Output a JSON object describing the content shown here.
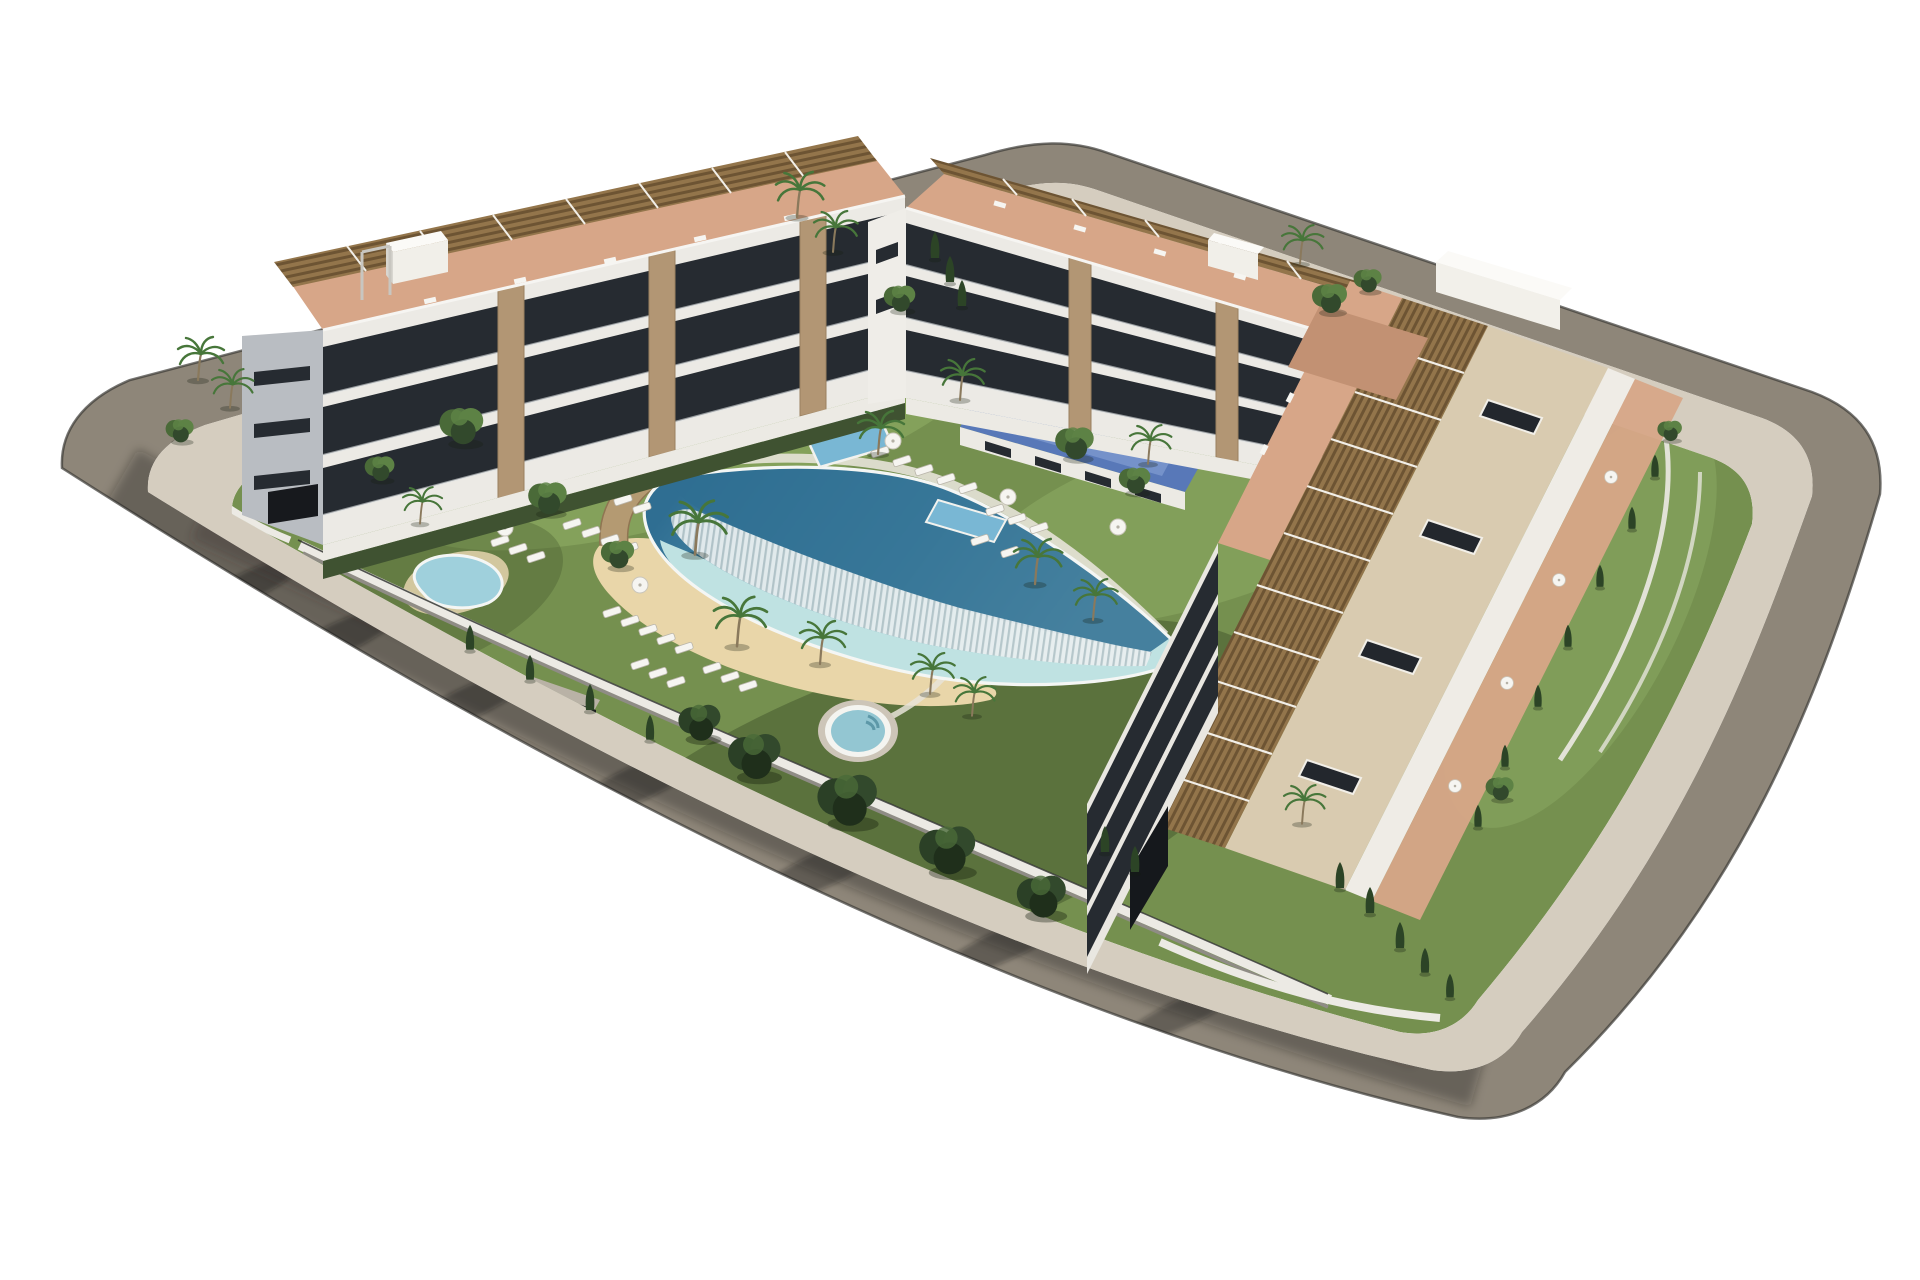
{
  "image_type": "architectural_3d_render",
  "subject": "Aerial isometric 3D rendering of a modern white Mediterranean apartment complex built around a landscaped courtyard with a lagoon-style pool, on a rounded corner plot surrounded by an empty asphalt road on a plain white background",
  "environment": {
    "background": "plain white, no context",
    "lighting": "bright sunlight from the upper right",
    "shadow_direction": "cast toward lower left, long tree shadows on the road"
  },
  "site": {
    "road": "asphalt ring road wrapping the whole plot with rounded corners",
    "sidewalk": "light paved sidewalk band inside the road",
    "perimeter": "white garden walls with hedges, cypresses and dark metal fencing"
  },
  "buildings": [
    {
      "id": "west-wing",
      "position": "upper left",
      "floors_visible": 4,
      "features": [
        "white slab facades",
        "dark glazed balcony bands",
        "stone-clad piers",
        "terracotta rooftop terraces",
        "row of brown louvered pergolas",
        "small rooftop pavilion",
        "garage opening at street level"
      ]
    },
    {
      "id": "north-wing",
      "position": "upper centre",
      "floors_visible": 3,
      "features": [
        "white slab facades",
        "dark glazed balcony bands",
        "stone-clad piers",
        "terracotta rooftop terraces with pergolas",
        "blue leisure deck at its base",
        "white podium wall"
      ]
    },
    {
      "id": "east-wing",
      "position": "right",
      "floors_visible": 4,
      "features": [
        "long flat beige roof with dark skylights",
        "continuous row of brown louvered pergola terraces",
        "dark curtain-wall facade to the courtyard",
        "street-side terraces with white parasols",
        "white rooftop box at north end",
        "garage opening at south end"
      ]
    }
  ],
  "amenities": [
    "curved lagoon swimming pool with infinity wave edge and white ribbed cascade wall",
    "sandy beach entry around the pool",
    "round spa / jacuzzi pool with steps",
    "kidney-shaped splash pool",
    "small plunge pool",
    "raised blue sports-and-leisure deck",
    "sun loungers in rows on the lawns",
    "white parasols",
    "palm trees, round garden trees and cypresses"
  ],
  "counts": {
    "main_buildings": 3,
    "water_features": 5,
    "lagoon_pools": 1,
    "spa_pools": 1
  },
  "palette": {
    "bg": "#ffffff",
    "road": "#8e8679",
    "sidewalk": "#d5cdbf",
    "lawn": "#75904f",
    "lawn_bright": "#8fae66",
    "lawn_shade": "#46592f",
    "sand": "#e9d6a9",
    "pool_deep": "#2f6e92",
    "pool_mid": "#66a4ba",
    "pool_shallow": "#bfe2e2",
    "pool_rim": "#f4f6f4",
    "stone_wall": "#b49a72",
    "wall_white": "#eceae4",
    "wall_shade": "#8f8c85",
    "bldg_white": "#eceae5",
    "gable_shade": "#b9bdc2",
    "glass_dark": "#262b31",
    "terracotta": "#d7a688",
    "terracotta_shade": "#c29173",
    "pergola": "#93754b",
    "pergola_stripe": "#6d5433",
    "roof_beige": "#d9cbb0",
    "skylight": "#23272d",
    "padel_blue": "#5878b8",
    "padel_light": "#7f9bd0",
    "water_small": "#79b7d4",
    "jacuzzi_water": "#93c6d2",
    "kidney_water": "#9fd0dc",
    "tree_dark": "#32492c",
    "tree_mid": "#4a6a38",
    "tree_light": "#5d8245",
    "cypress": "#2c4426",
    "palm_green": "#47763a",
    "trunk": "#8a795c",
    "lounger_white": "#f6f5f1",
    "stone_pier": "#b29674"
  }
}
